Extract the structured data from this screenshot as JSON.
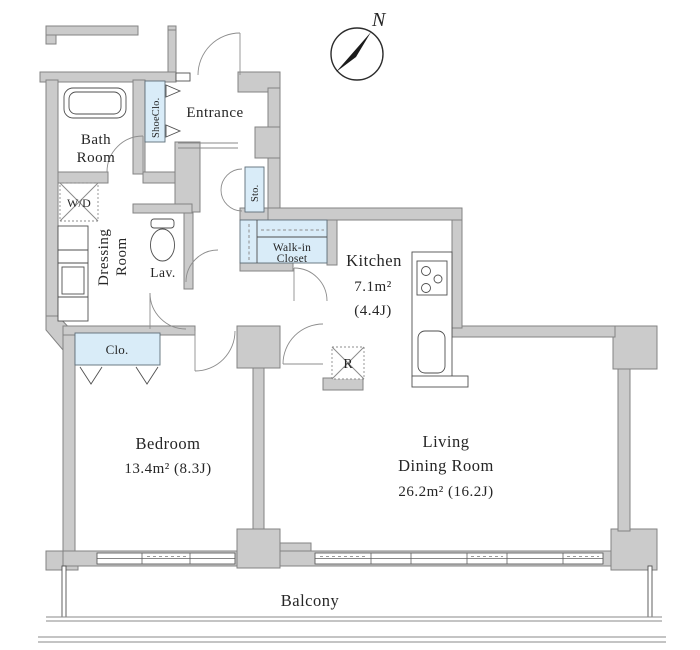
{
  "compass": {
    "north_label": "N"
  },
  "rooms": {
    "entrance": {
      "label": "Entrance"
    },
    "bath": {
      "line1": "Bath",
      "line2": "Room"
    },
    "shoe_closet": {
      "label": "ShoeClo."
    },
    "storage": {
      "label": "Sto."
    },
    "washer_dryer": {
      "label": "W/D"
    },
    "dressing": {
      "line1": "Dressing",
      "line2": "Room"
    },
    "lavatory": {
      "label": "Lav."
    },
    "walk_in_closet": {
      "line1": "Walk-in",
      "line2": "Closet"
    },
    "kitchen": {
      "label": "Kitchen",
      "area_sqm": "7.1m²",
      "area_jo": "(4.4J)"
    },
    "refrigerator": {
      "label": "R"
    },
    "closet": {
      "label": "Clo."
    },
    "bedroom": {
      "label": "Bedroom",
      "area": "13.4m²  (8.3J)"
    },
    "living": {
      "line1": "Living",
      "line2": "Dining Room",
      "area": "26.2m²  (16.2J)"
    },
    "balcony": {
      "label": "Balcony"
    }
  },
  "colors": {
    "wall_fill": "#cbcbcb",
    "wall_stroke": "#838383",
    "closet_fill": "#d9ecf8",
    "line": "#4f4f4f",
    "text": "#262626"
  }
}
